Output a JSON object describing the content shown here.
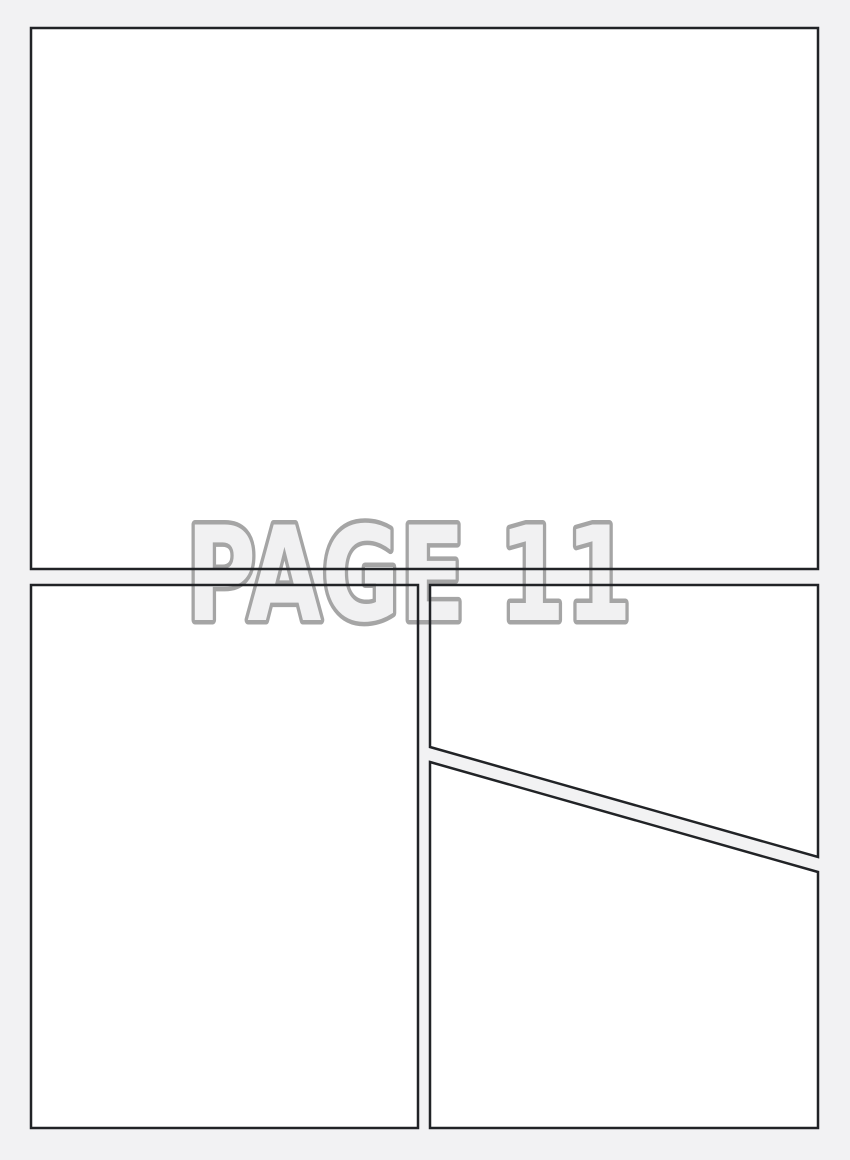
{
  "page": {
    "label": "PAGE 11"
  },
  "colors": {
    "background": "#f2f2f3",
    "panel_fill": "#ffffff",
    "panel_border": "#212326",
    "label_stroke": "#a5a5a5",
    "label_fill": "#f1f1f2"
  }
}
